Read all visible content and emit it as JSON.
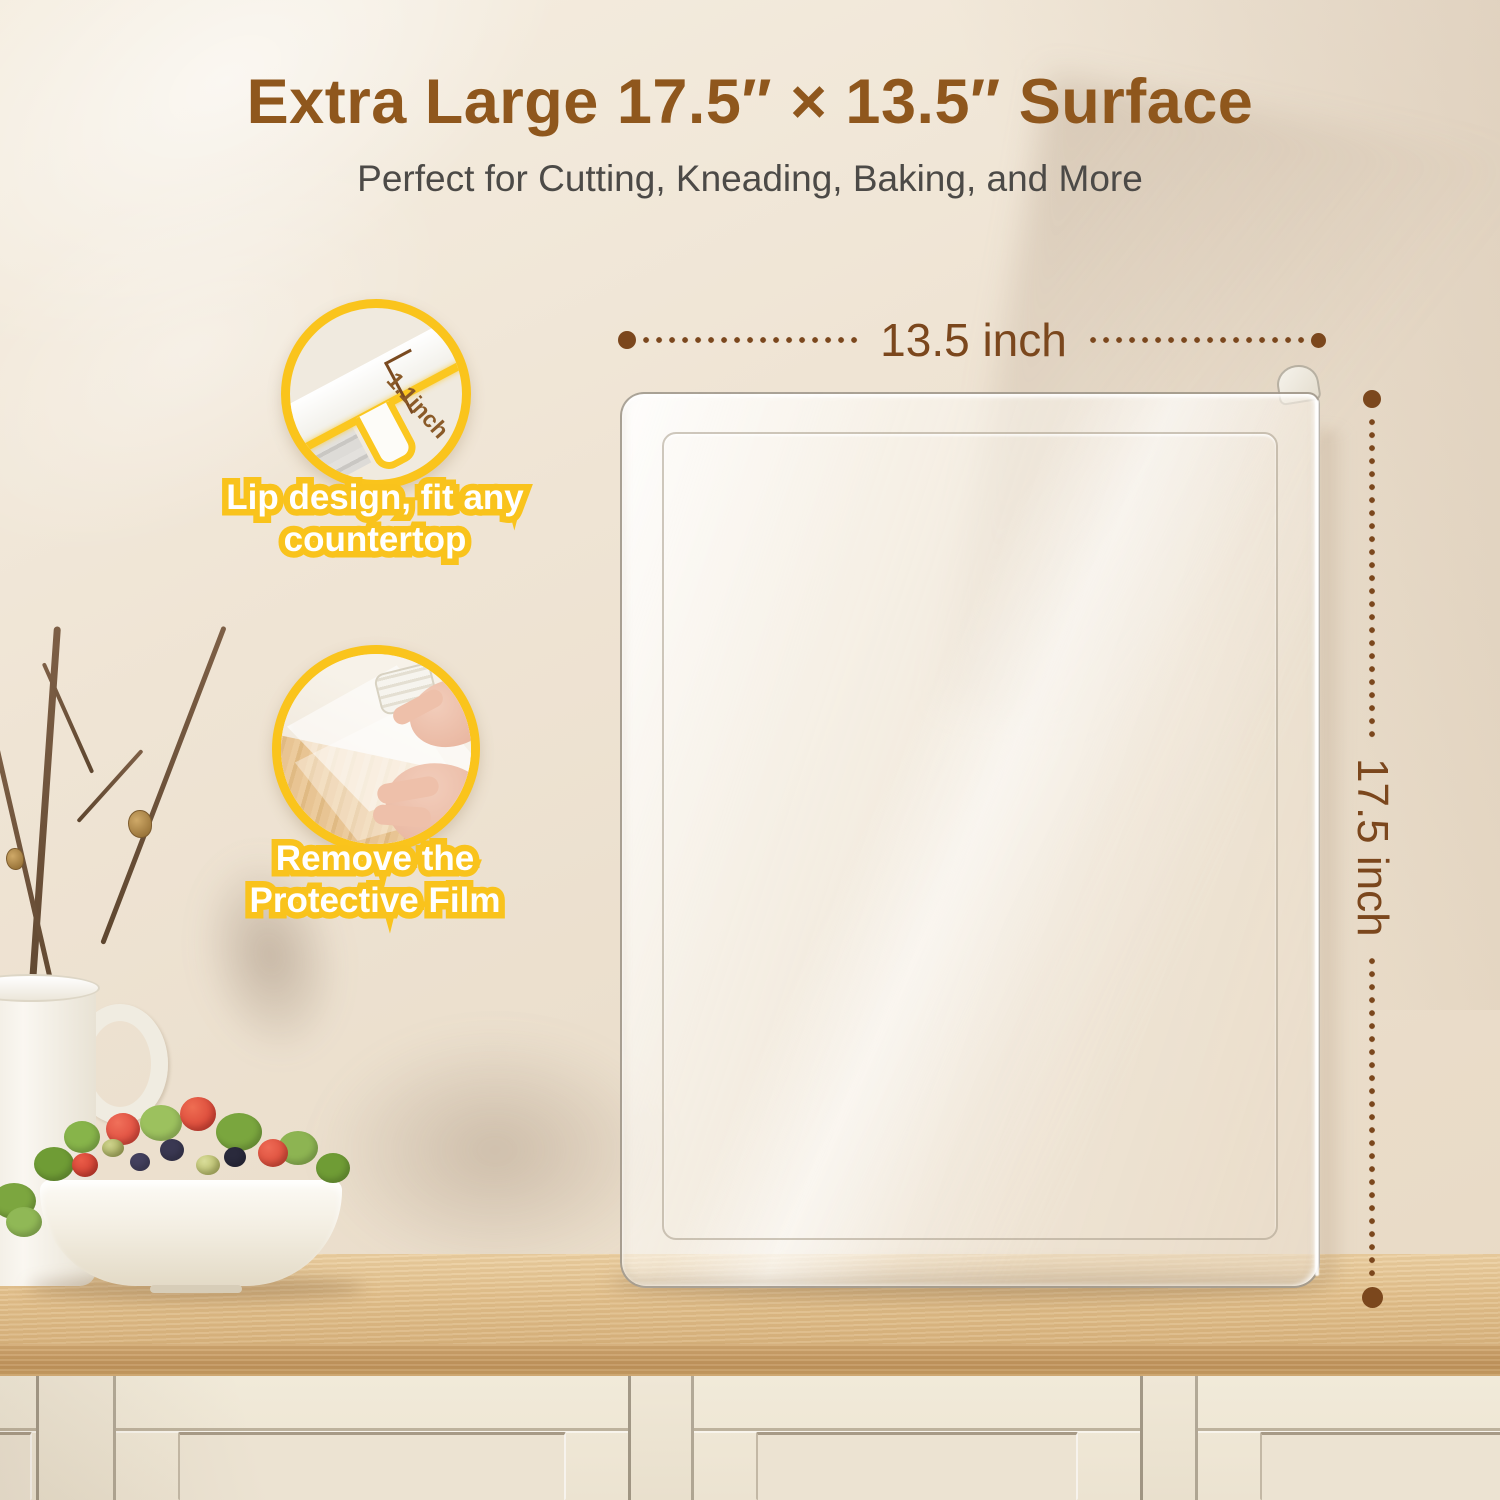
{
  "header": {
    "title": "Extra Large 17.5″ × 13.5″ Surface",
    "subtitle": "Perfect for Cutting, Kneading, Baking, and More"
  },
  "dimensions": {
    "width_label": "13.5 inch",
    "height_label": "17.5 inch"
  },
  "callouts": [
    {
      "id": "lip-design",
      "caption_lines": [
        "Lip design, fit any",
        "countertop"
      ],
      "detail_label": "1.1inch"
    },
    {
      "id": "remove-film",
      "caption_lines": [
        "Remove the",
        "Protective Film"
      ]
    }
  ],
  "colors": {
    "accent_yellow": "#FAC41C",
    "title_brown": "#8F571D",
    "dimension_brown": "#7B471D",
    "subtitle_gray": "#4C4A47",
    "wood_counter": "#E3C18D",
    "cabinet_cream": "#EFE8D8"
  }
}
